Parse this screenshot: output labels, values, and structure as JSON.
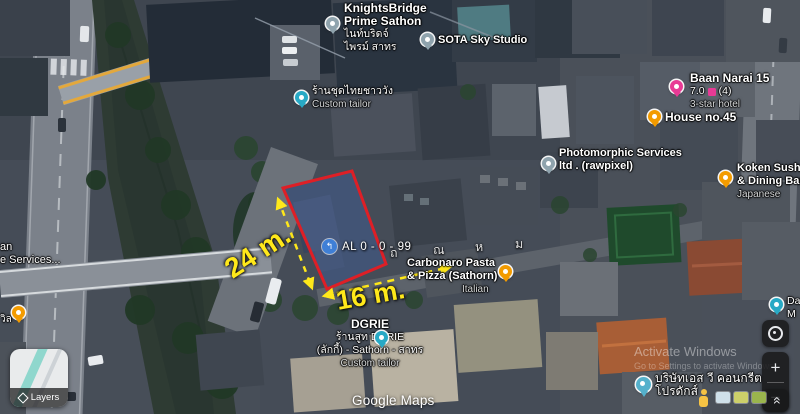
{
  "map": {
    "road_letters": [
      "ถ",
      "ณ",
      "ห",
      "ม"
    ]
  },
  "plot": {
    "label": "AL 0 - 0 - 99",
    "depth_label": "24 m.",
    "width_label": "16 m.",
    "outline_color": "#de1f26",
    "dimension_color": "#ffe81a",
    "fill_color": "#7d9bd7"
  },
  "pois": {
    "knightsbridge": {
      "line1": "KnightsBridge",
      "line2": "Prime Sathon",
      "line3": "ไนท์บริดจ์",
      "line4": "ไพรม์ สาทร"
    },
    "sota": {
      "name": "SOTA Sky Studio"
    },
    "thai_tailor": {
      "line1": "ร้านชุดไทยชาววัง",
      "line2": "Custom tailor"
    },
    "photomorphic": {
      "line1": "Photomorphic Services",
      "line2": "ltd . (rawpixel)"
    },
    "baan_narai": {
      "name": "Baan Narai 15",
      "rating": "7.0",
      "reviews": "(4)",
      "category": "3-star hotel"
    },
    "house45": {
      "name": "House no.45"
    },
    "koken": {
      "line1": "Koken Sushi",
      "line2": "& Dining Bar",
      "category": "Japanese"
    },
    "carbonaro": {
      "line1": "Carbonaro Pasta",
      "line2": "& Pizza (Sathorn)",
      "category": "Italian"
    },
    "dgrie": {
      "name": "DGRIE",
      "line2": "ร้านสูท DGRIE",
      "line3": "(ลักกี้) - Sathorn - สาทร",
      "line4": "Custom tailor"
    },
    "sv_concrete": {
      "line1": "บริษัทเอส วี คอนกรีต",
      "line2": "โปรดักส์"
    },
    "left_poi": {
      "line1": "an",
      "line2": "e Services..."
    },
    "left_cafe": {
      "label": "วิล"
    },
    "right_poi": {
      "line1": "Da",
      "line2": "M"
    }
  },
  "controls": {
    "layers_label": "Layers",
    "zoom_in": "+",
    "zoom_out": "−"
  },
  "icons": {
    "chevrons_up": "»",
    "parcel_arrow": "↰"
  },
  "watermarks": {
    "google": "Google Maps",
    "activate_line1": "Activate Windows",
    "activate_line2": "Go to Settings to activate Windows."
  },
  "colors": {
    "pin_generic": "#8fa3ad",
    "pin_food": "#f39b00",
    "pin_hotel": "#e83a95",
    "pin_shop": "#28a9c5",
    "pin_search": "#55b1cc",
    "rating_badge": "#e83a95",
    "label_text": "#ffffff",
    "category_text": "#d7d9da"
  }
}
